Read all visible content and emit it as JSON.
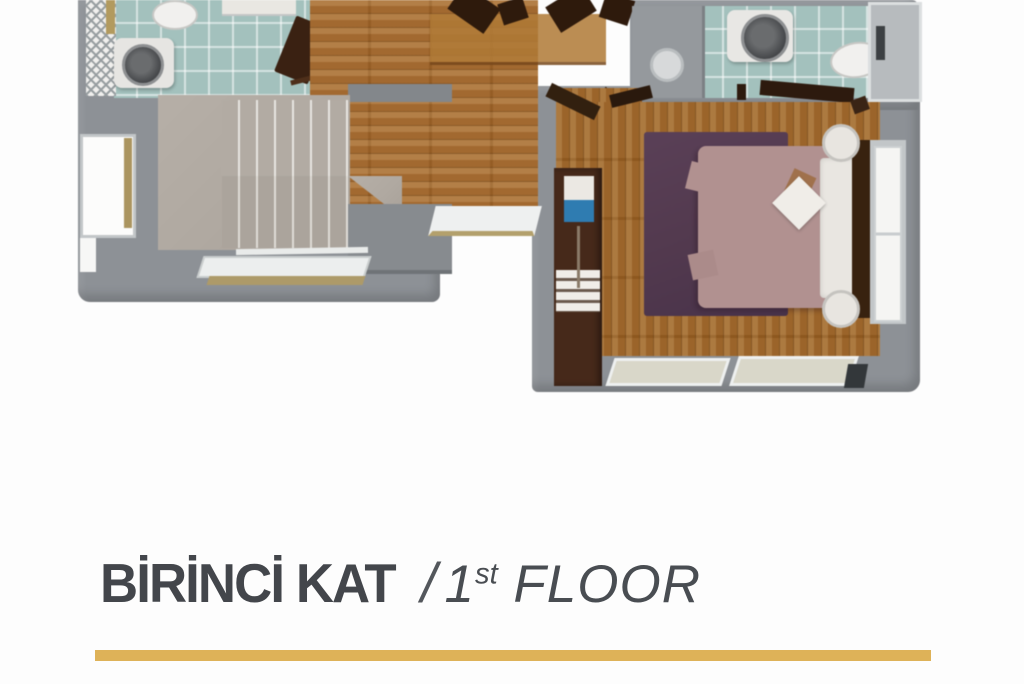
{
  "caption": {
    "turkish": "BİRİNCİ KAT",
    "separator": "/",
    "english_number": "1",
    "english_ordinal": "st",
    "english_word": "FLOOR"
  },
  "palette": {
    "accent_gold": "#deb258",
    "caption_text": "#43464b",
    "wall_gray": "#8d9196",
    "wood_floor_hall": "#a76c2e",
    "wood_floor_bedroom": "#9e6526",
    "tile_teal": "#a3c1bd",
    "stone_stairs": "#b2aba3",
    "rug_plum": "#533a4f",
    "bed_mauve": "#b19190",
    "pillow_white": "#e9e6e1",
    "dark_wood_furniture": "#46291a",
    "tv_blue": "#2f7cb1"
  }
}
